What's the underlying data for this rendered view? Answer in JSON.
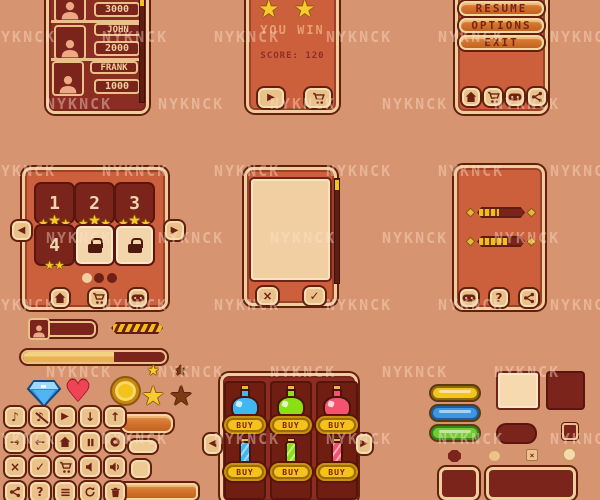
{
  "watermark": {
    "text": "NYKNCK",
    "color": "#ffe0cc"
  },
  "palette": {
    "background": "#d69470",
    "panel_orange": "#cc5f3c",
    "panel_maroon": "#8c2d23",
    "border_tan": "#efce9e",
    "outline_dark": "#63200f",
    "button_tan": "#e9c189",
    "cream": "#f2cfa2",
    "gold": "#f2c21e",
    "text_maroon": "#77251b",
    "star_yellow": "#f8ca2e"
  },
  "leaderboard": {
    "entries": [
      {
        "name": "",
        "score": "3000"
      },
      {
        "name": "JOHN",
        "score": "2000"
      },
      {
        "name": "FRANK",
        "score": "1000"
      }
    ]
  },
  "win_dialog": {
    "title": "YOU WIN",
    "score_label": "SCORE: 120",
    "stars_visible": 2,
    "buttons": [
      "play",
      "shop-cart"
    ]
  },
  "pause_menu": {
    "items": [
      "RESUME",
      "OPTIONS",
      "EXIT"
    ],
    "footer_icons": [
      "home",
      "shop-cart",
      "gamepad",
      "share"
    ]
  },
  "level_select": {
    "levels": [
      {
        "label": "1",
        "stars": 3,
        "locked": false
      },
      {
        "label": "2",
        "stars": 3,
        "locked": false
      },
      {
        "label": "3",
        "stars": 3,
        "locked": false
      },
      {
        "label": "4",
        "stars": 2,
        "locked": false
      },
      {
        "label": "",
        "stars": 0,
        "locked": true
      },
      {
        "label": "",
        "stars": 0,
        "locked": true
      }
    ],
    "nav": [
      "prev",
      "next"
    ],
    "page_dots": {
      "count": 3,
      "active": 0
    },
    "footer_icons": [
      "home",
      "shop-cart",
      "gamepad"
    ]
  },
  "confirm_dialog": {
    "buttons": [
      "close",
      "check"
    ]
  },
  "settings_panel": {
    "sliders": [
      {
        "name": "slider-1",
        "percent": 42
      },
      {
        "name": "slider-2",
        "percent": 58
      }
    ],
    "footer_icons": [
      "gamepad",
      "help",
      "share"
    ]
  },
  "hud": {
    "chevron_meter": {
      "percent": 100
    },
    "progress_bar": {
      "percent": 64
    }
  },
  "shop": {
    "buy_label": "BUY",
    "item_colors": {
      "blue": "#41b6f2",
      "green": "#8ae012",
      "red": "#f2536e"
    },
    "rows": [
      [
        {
          "item": "potion",
          "color": "blue"
        },
        {
          "item": "potion",
          "color": "green"
        },
        {
          "item": "potion",
          "color": "red"
        }
      ],
      [
        {
          "item": "vial",
          "color": "blue"
        },
        {
          "item": "vial",
          "color": "green"
        },
        {
          "item": "vial",
          "color": "red"
        }
      ]
    ],
    "nav": [
      "prev",
      "next"
    ]
  },
  "icon_grid": {
    "rows": [
      [
        "music-note",
        "music-off",
        "play",
        "arrow-down",
        "arrow-up"
      ],
      [
        "arrow-right",
        "arrow-left",
        "home",
        "pause",
        "record"
      ],
      [
        "close",
        "check",
        "shop-cart",
        "sound-off",
        "sound-on"
      ],
      [
        "share",
        "help",
        "menu-list",
        "restart",
        "trash"
      ]
    ]
  },
  "swatches": {
    "pills": [
      {
        "color": "#f4c41e",
        "border": "#8f6b07"
      },
      {
        "color": "#3f97e0",
        "border": "#1b5fa0"
      },
      {
        "color": "#72cb32",
        "border": "#2f8a1a"
      }
    ]
  },
  "glyphs": {
    "play": "▶",
    "prev": "◀",
    "next": "▶",
    "arrow-up": "↑",
    "arrow-down": "↓",
    "arrow-left": "←",
    "arrow-right": "→",
    "music-note": "♪",
    "music-off": "♪",
    "close": "×",
    "check": "✓",
    "help": "?",
    "home2": "⌂"
  }
}
